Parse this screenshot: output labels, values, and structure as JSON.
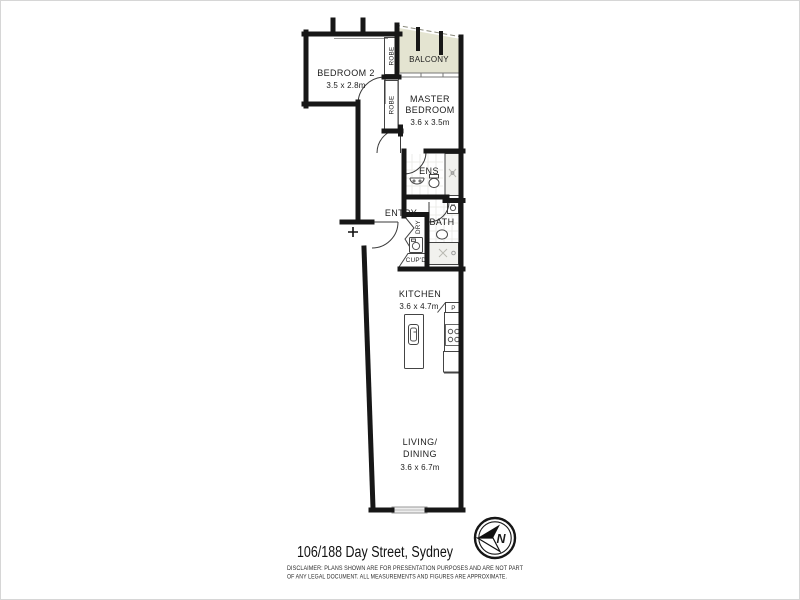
{
  "colors": {
    "wall": "#171717",
    "thin_line": "#3d3d3d",
    "balcony_fill": "#e4e4d1",
    "shower_fill": "#f1f1ee",
    "window_fill": "#ededed",
    "tile_line": "#e7e7e4"
  },
  "rooms": {
    "bedroom2": {
      "name": "BEDROOM 2",
      "dims": "3.5 x 2.8m"
    },
    "balcony": {
      "name": "BALCONY"
    },
    "master_bedroom": {
      "name_line1": "MASTER",
      "name_line2": "BEDROOM",
      "dims": "3.6 x 3.5m"
    },
    "ensuite": {
      "name": "ENS"
    },
    "entry": {
      "name": "ENTRY"
    },
    "bath": {
      "name": "BATH"
    },
    "kitchen": {
      "name": "KITCHEN",
      "dims": "3.6 x 4.7m"
    },
    "living_dining": {
      "name_line1": "LIVING/",
      "name_line2": "DINING",
      "dims": "3.6 x 6.7m"
    }
  },
  "storage": {
    "robe_upper": "ROBE",
    "robe_lower": "ROBE",
    "dryer": "DRY",
    "cupboard": "CUP'D",
    "pantry": "P"
  },
  "compass": {
    "north_label": "N"
  },
  "footer": {
    "address": "106/188 Day Street, Sydney",
    "disclaimer_line1": "DISCLAIMER:  PLANS SHOWN ARE FOR PRESENTATION PURPOSES AND ARE NOT PART",
    "disclaimer_line2": "OF ANY LEGAL DOCUMENT. ALL MEASUREMENTS AND FIGURES ARE APPROXIMATE."
  }
}
